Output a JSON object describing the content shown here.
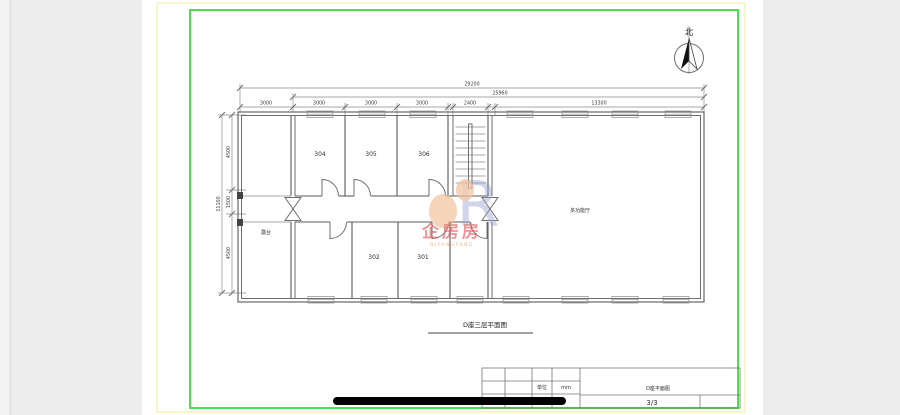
{
  "colors": {
    "canvas_bg": "#ededed",
    "page_bg": "#ffffff",
    "frame_yellow": "#f3efa6",
    "frame_green": "#4ae04a",
    "line": "#6e6e6e",
    "text": "#3a3a3a",
    "redaction": "#000000",
    "watermark_blue": "#98a0cf",
    "watermark_peach": "#f2c09a",
    "watermark_red": "#e25c5c",
    "watermark_orange": "#f0a070"
  },
  "north": {
    "label": "北"
  },
  "dims": {
    "top": {
      "overall": "29200",
      "sub": "25960",
      "segments": [
        "3000",
        "3000",
        "3000",
        "3000",
        "2400",
        "13300"
      ]
    },
    "left": {
      "overall": "11100",
      "segments": [
        "4500",
        "1500",
        "4500"
      ]
    }
  },
  "rooms": {
    "top": [
      "304",
      "305",
      "306"
    ],
    "bottom": [
      "302",
      "301"
    ],
    "hall": "多功能厅",
    "terrace": "露台"
  },
  "plan_title": "D座三层平面图",
  "watermark": {
    "letter": "R",
    "brand": "企房房",
    "brand_latin": "QIFANGFANG"
  },
  "title_block": {
    "unit_label": "单位",
    "unit_value": "mm",
    "drawing_title": "D座平面图",
    "sheet_number": "3/3"
  }
}
